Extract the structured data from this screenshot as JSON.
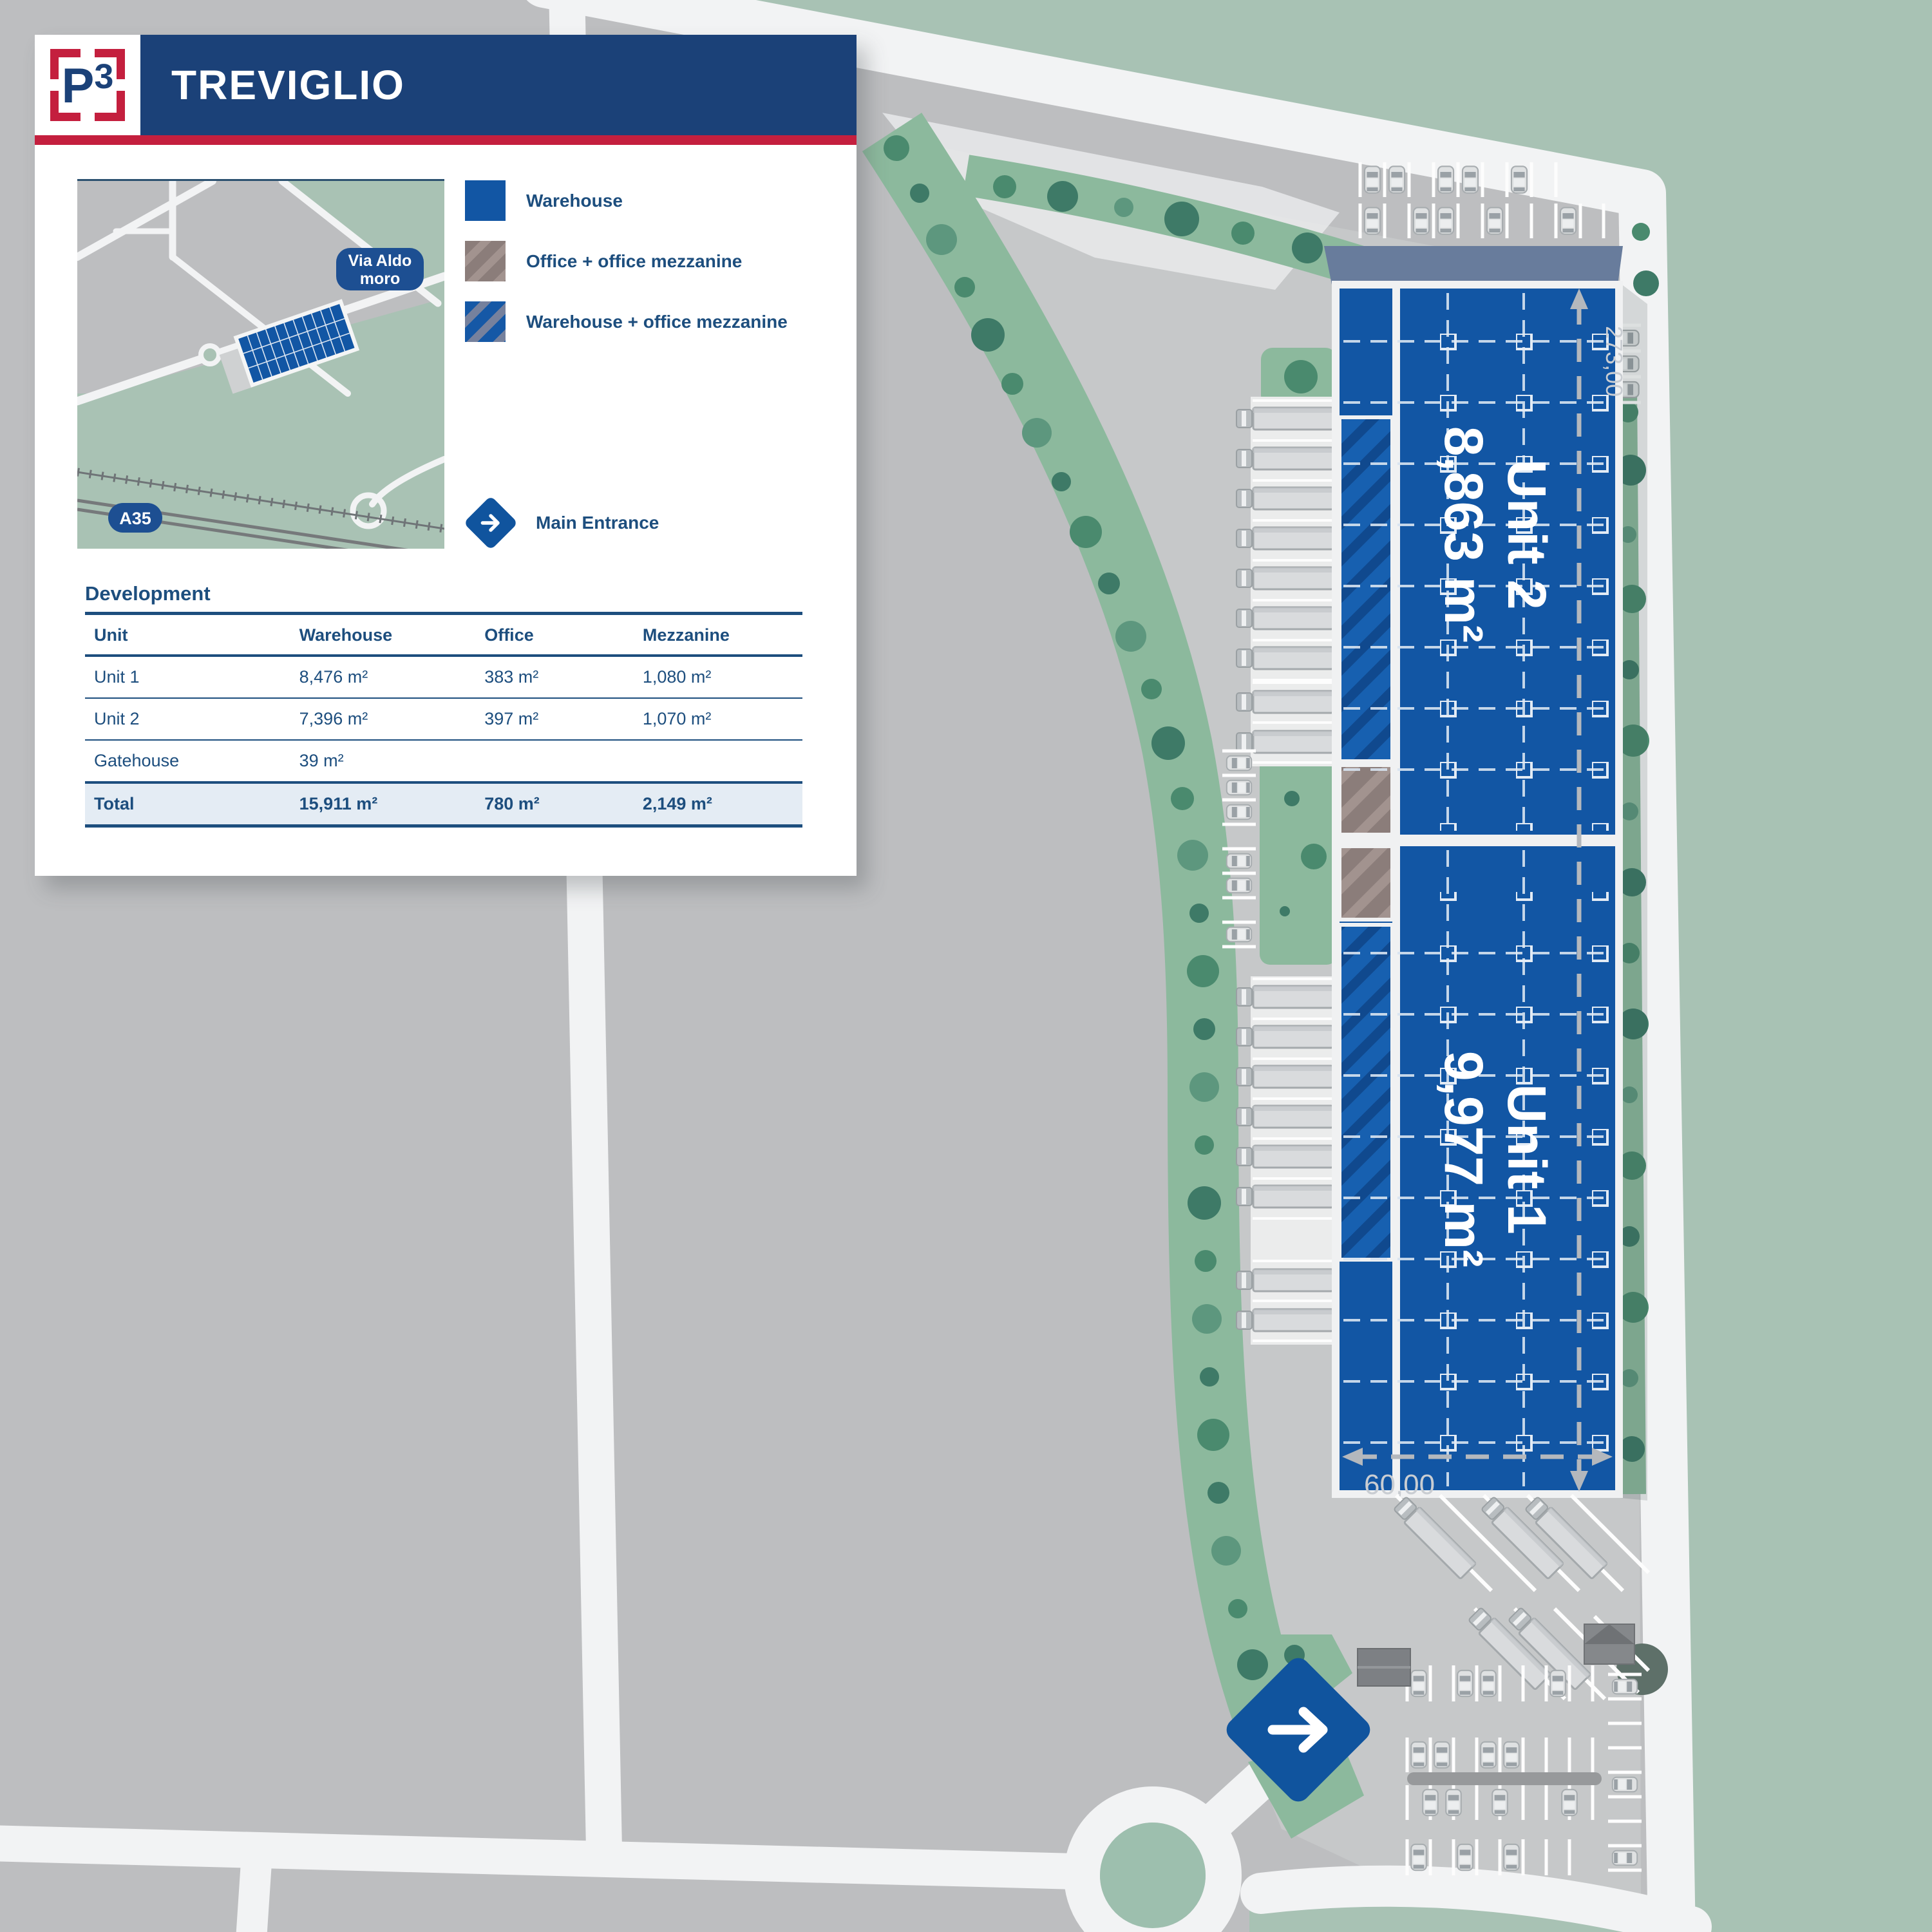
{
  "brand": {
    "logo_p": "P",
    "logo_3": "3"
  },
  "header": {
    "title": "TREVIGLIO"
  },
  "minimap": {
    "label_via_aldo_1": "Via Aldo",
    "label_via_aldo_2": "moro",
    "label_a35": "A35"
  },
  "legend": {
    "items": [
      {
        "label": "Warehouse",
        "swatch": "warehouse-solid-blue"
      },
      {
        "label": "Office + office mezzanine",
        "swatch": "brown-hatch"
      },
      {
        "label": "Warehouse + office mezzanine",
        "swatch": "blue-hatch"
      }
    ]
  },
  "entrance": {
    "label": "Main Entrance"
  },
  "development": {
    "heading": "Development",
    "columns": [
      "Unit",
      "Warehouse",
      "Office",
      "Mezzanine"
    ],
    "rows": [
      [
        "Unit 1",
        "8,476 m²",
        "383 m²",
        "1,080 m²"
      ],
      [
        "Unit 2",
        "7,396 m²",
        "397 m²",
        "1,070 m²"
      ],
      [
        "Gatehouse",
        "39 m²",
        "",
        ""
      ]
    ],
    "total": [
      "Total",
      "15,911 m²",
      "780 m²",
      "2,149 m²"
    ]
  },
  "plan": {
    "unit2_name": "Unit 2",
    "unit2_area": "8,863 m²",
    "unit1_name": "Unit 1",
    "unit1_area": "9,977 m²",
    "dim_length": "273,00",
    "dim_width": "60,00"
  },
  "colors": {
    "brand_blue": "#1b4178",
    "brand_red": "#c41f3e",
    "building_blue": "#1256a4",
    "navy_text": "#1d4e7e",
    "sage_background": "#a8c2b4"
  }
}
